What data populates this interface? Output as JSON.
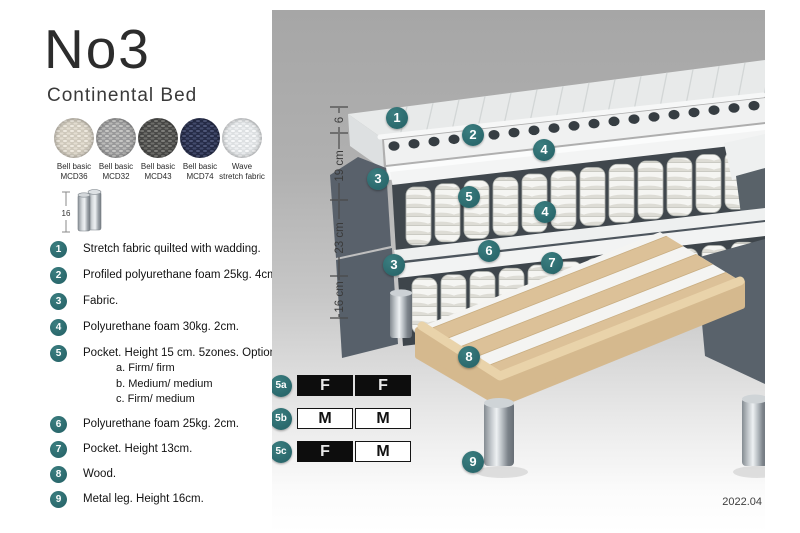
{
  "header": {
    "model": "No3",
    "subtitle": "Continental Bed"
  },
  "fabric_swatches": [
    {
      "label_line1": "Bell basic",
      "label_line2": "MCD36",
      "color": "#cfc9bc"
    },
    {
      "label_line1": "Bell basic",
      "label_line2": "MCD32",
      "color": "#99999a"
    },
    {
      "label_line1": "Bell basic",
      "label_line2": "MCD43",
      "color": "#4a4a48"
    },
    {
      "label_line1": "Bell basic",
      "label_line2": "MCD74",
      "color": "#262c48"
    },
    {
      "label_line1": "Wave",
      "label_line2": "stretch fabric",
      "color": "#dde0e2"
    }
  ],
  "leg_icon": {
    "height_label": "16"
  },
  "legend": {
    "items": [
      {
        "num": "1",
        "text": "Stretch fabric quilted with wadding."
      },
      {
        "num": "2",
        "text": "Profiled polyurethane foam 25kg. 4cm."
      },
      {
        "num": "3",
        "text": "Fabric."
      },
      {
        "num": "4",
        "text": "Polyurethane foam 30kg. 2cm."
      },
      {
        "num": "5",
        "text": "Pocket. Height 15 cm. 5zones. Option:",
        "options": [
          "a. Firm/ firm",
          "b. Medium/ medium",
          "c. Firm/ medium"
        ]
      },
      {
        "num": "6",
        "text": "Polyurethane foam 25kg. 2cm."
      },
      {
        "num": "7",
        "text": "Pocket. Height 13cm."
      },
      {
        "num": "8",
        "text": "Wood."
      },
      {
        "num": "9",
        "text": "Metal leg. Height 16cm."
      }
    ]
  },
  "diagram": {
    "measurements": [
      "6",
      "19 cm",
      "23 cm",
      "16 cm"
    ],
    "callouts": [
      "1",
      "2",
      "4",
      "3",
      "5",
      "4",
      "6",
      "7",
      "3",
      "8",
      "9"
    ],
    "firmness_table": {
      "rows": [
        {
          "label": "5a",
          "cells": [
            {
              "text": "F",
              "filled": true
            },
            {
              "text": "F",
              "filled": true
            }
          ]
        },
        {
          "label": "5b",
          "cells": [
            {
              "text": "M",
              "filled": false
            },
            {
              "text": "M",
              "filled": false
            }
          ]
        },
        {
          "label": "5c",
          "cells": [
            {
              "text": "F",
              "filled": true
            },
            {
              "text": "M",
              "filled": false
            }
          ]
        }
      ]
    },
    "version": "2022.04"
  },
  "colors": {
    "accent_teal": "#2e6f72",
    "fabric_dark": "#59616b",
    "wood": "#dcc198",
    "table_filled": "#0d0d0d",
    "photo_background_top": "#a6a6a6"
  }
}
